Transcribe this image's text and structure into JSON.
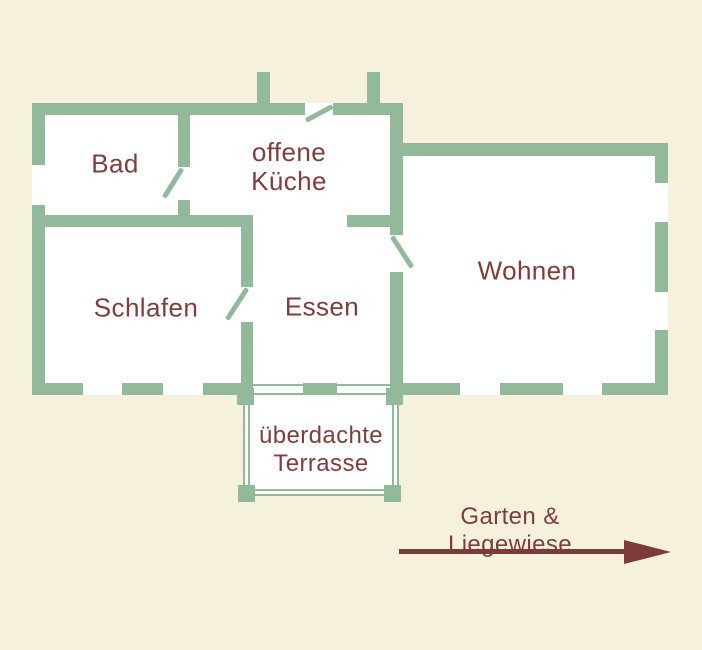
{
  "colors": {
    "background": "#f6f1dc",
    "wall": "#92ba9a",
    "room_fill": "#ffffff",
    "text": "#7f3e3c",
    "arrow": "#7c3b38"
  },
  "rooms": {
    "bad": "Bad",
    "kueche": "offene\nKüche",
    "schlafen": "Schlafen",
    "essen": "Essen",
    "wohnen": "Wohnen",
    "terrasse": "überdachte\nTerrasse"
  },
  "garden": {
    "label": "Garten & Liegewiese"
  }
}
